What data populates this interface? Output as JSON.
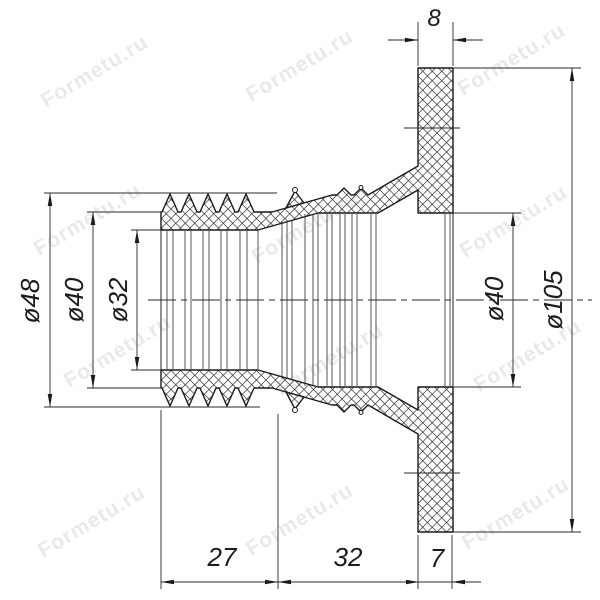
{
  "title": "Sectional drawing of flanged corrugated rubber coupling",
  "dims": {
    "d48": "ø48",
    "d40_left": "ø40",
    "d32": "ø32",
    "d40_right": "ø40",
    "d105": "ø105",
    "top8": "8",
    "b27": "27",
    "b32": "32",
    "b7": "7"
  },
  "watermark": {
    "text": "Formetu.ru"
  },
  "colors": {
    "line": "#1a1a1a",
    "thin": "#2a2a2a",
    "bg": "#ffffff"
  }
}
